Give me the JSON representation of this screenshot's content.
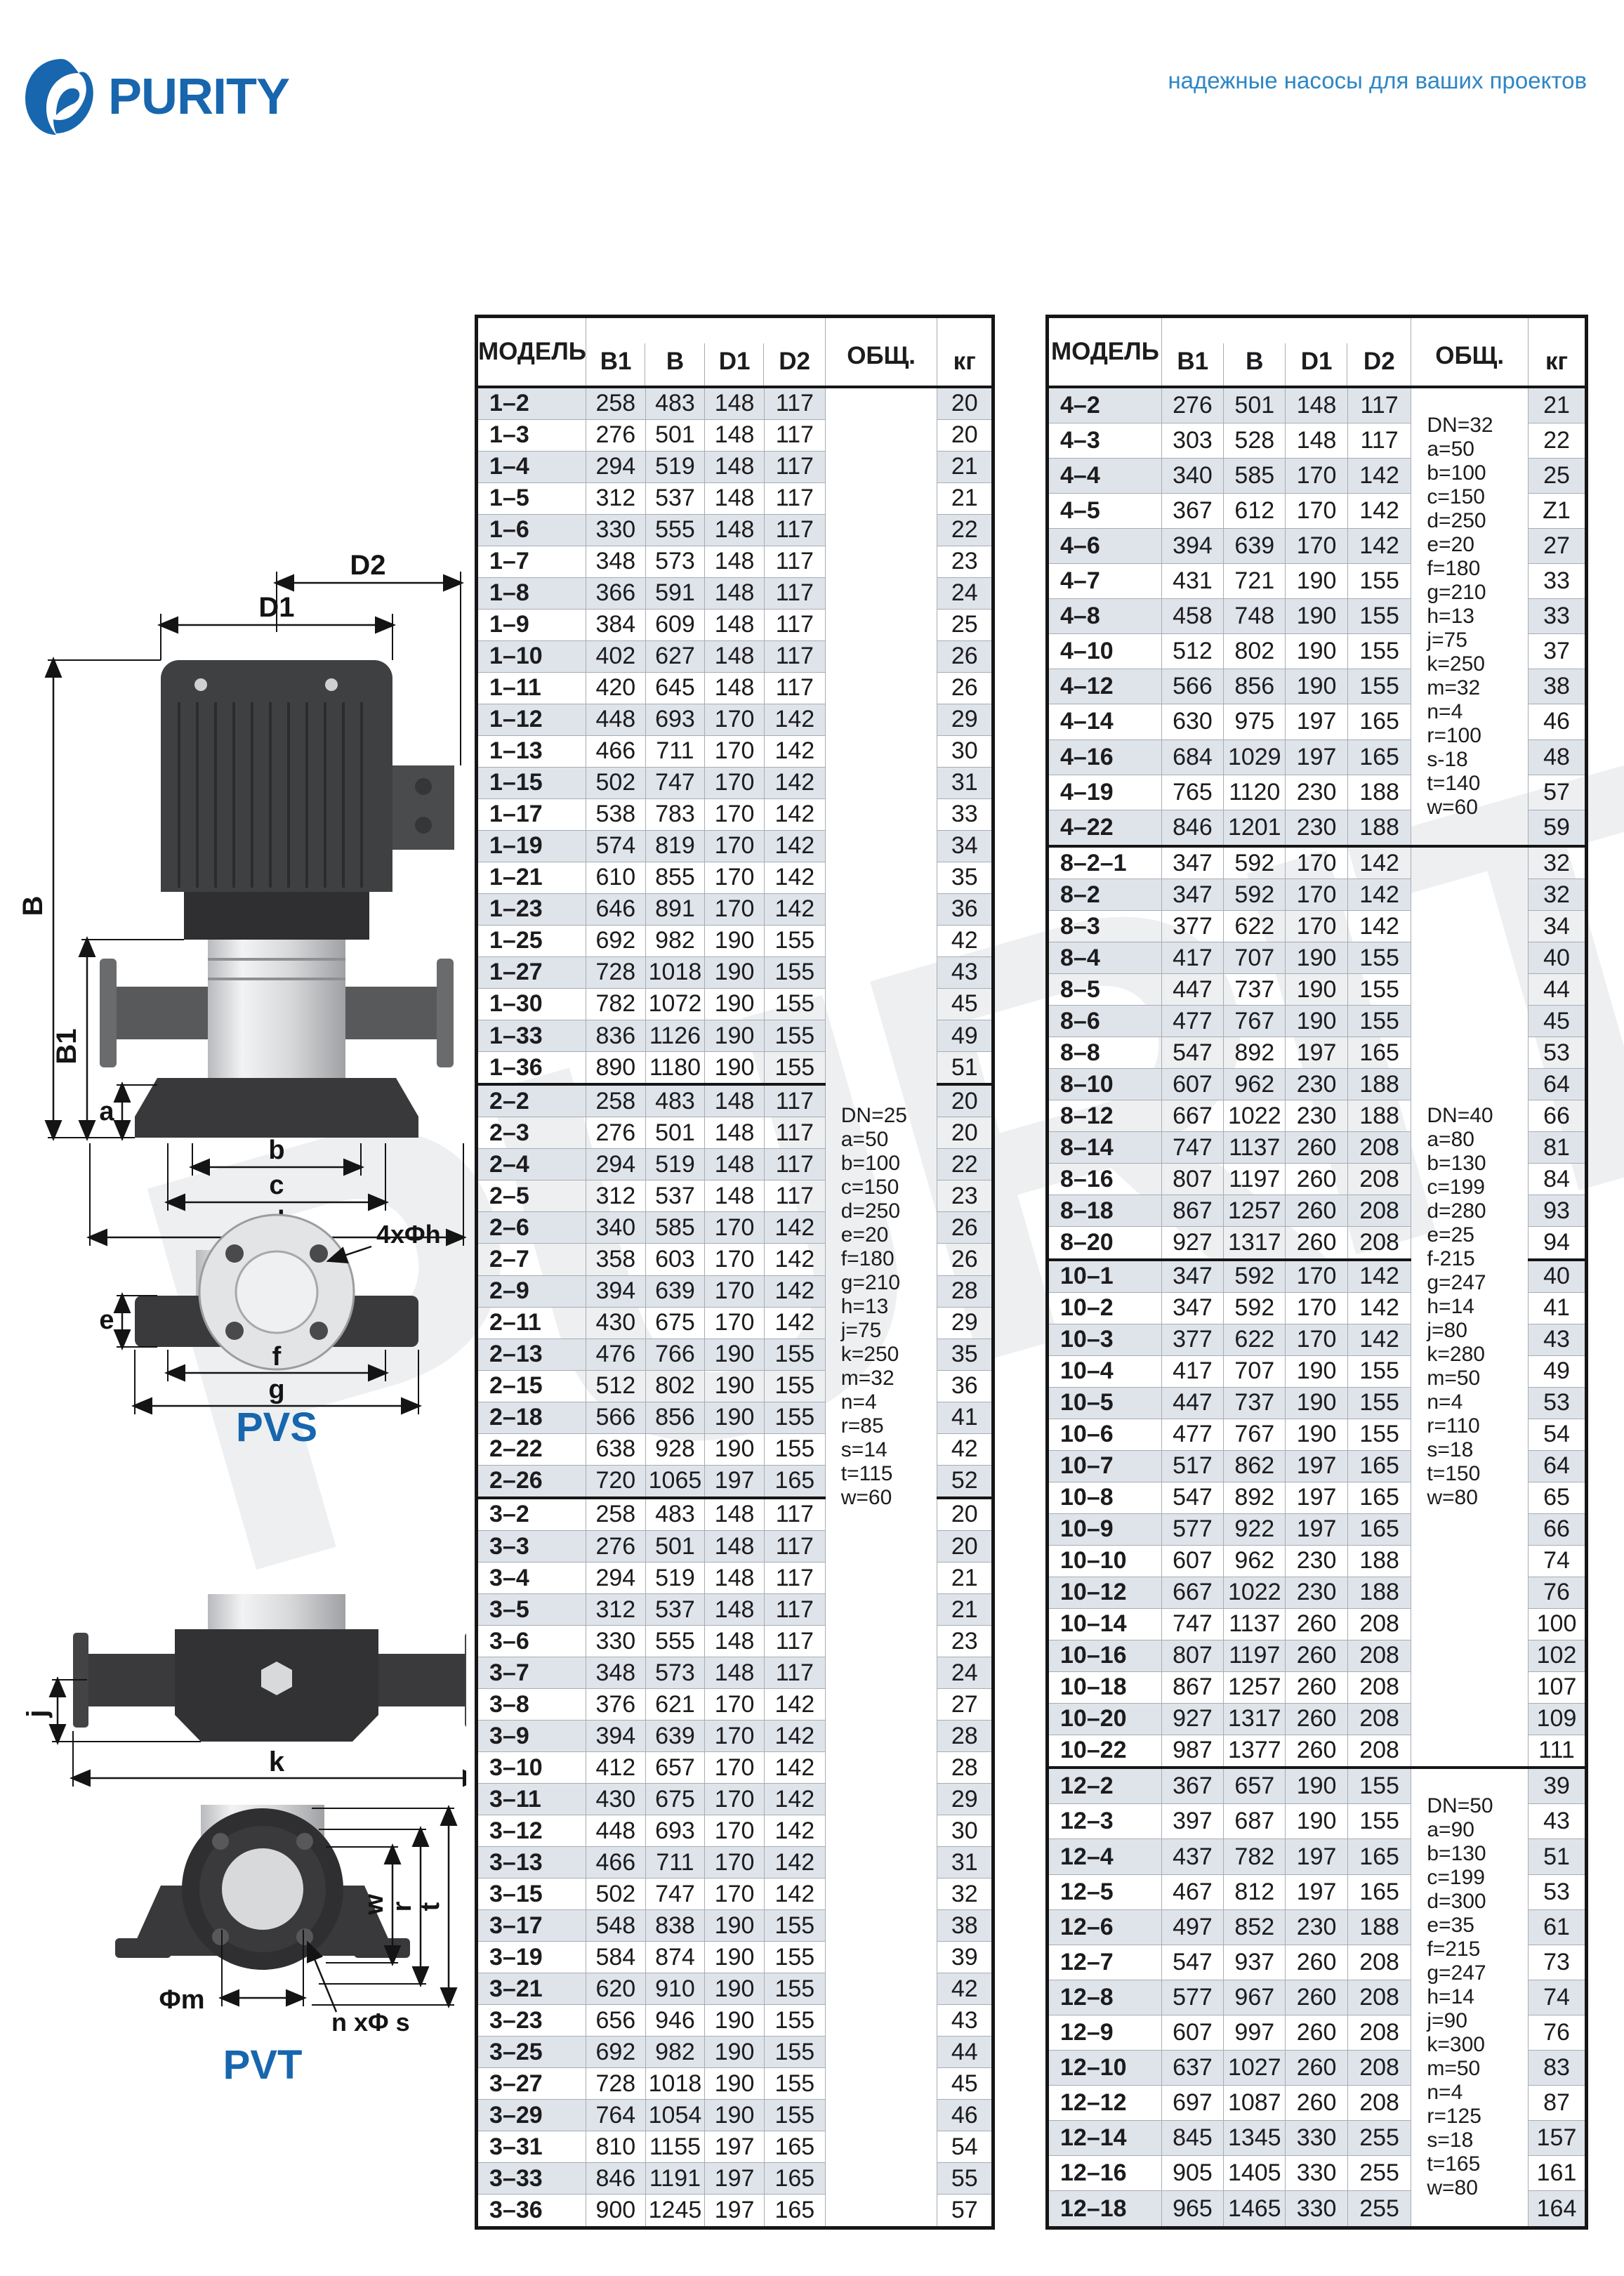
{
  "brand": {
    "logo_text": "PURITY",
    "tagline": "надежные насосы для ваших проектов"
  },
  "colors": {
    "brand_blue": "#1766ae",
    "tagline_blue": "#2e86c5",
    "row_shade": "#dfe4ea",
    "border_dark": "#161616",
    "border_light": "#a7adb3",
    "watermark": "#edeff1"
  },
  "diagrams": {
    "pvs": {
      "label": "PVS",
      "dims": {
        "D2": "D2",
        "D1": "D1",
        "B": "B",
        "B1": "B1",
        "a": "a",
        "b": "b",
        "c": "c",
        "d": "d",
        "bolt": "4xΦh",
        "e": "e",
        "f": "f",
        "g": "g"
      }
    },
    "pvt": {
      "label": "PVT",
      "dims": {
        "j": "j",
        "k": "k",
        "w": "w",
        "r": "r",
        "t": "t",
        "m": "Φm",
        "bolt": "n xΦ s"
      }
    }
  },
  "tables": [
    {
      "headers": {
        "model": "МОДЕЛЬ",
        "b1": "В1",
        "b": "В",
        "d1": "D1",
        "d2": "D2",
        "obsh": "ОБЩ.",
        "kg": "кг"
      },
      "col_widths": [
        "21.2%",
        "11.5%",
        "11.5%",
        "11.5%",
        "11.8%",
        "21.7%",
        "10.8%"
      ],
      "notes": [
        {
          "from_group": 0,
          "rowspan": 58,
          "lines": [
            "DN=25",
            "a=50",
            "b=100",
            "c=150",
            "d=250",
            "e=20",
            "f=180",
            "g=210",
            "h=13",
            "j=75",
            "k=250",
            "m=32",
            "n=4",
            "r=85",
            "s=14",
            "t=115",
            "w=60"
          ]
        }
      ],
      "groups": [
        [
          [
            "1–2",
            "258",
            "483",
            "148",
            "117",
            "20"
          ],
          [
            "1–3",
            "276",
            "501",
            "148",
            "117",
            "20"
          ],
          [
            "1–4",
            "294",
            "519",
            "148",
            "117",
            "21"
          ],
          [
            "1–5",
            "312",
            "537",
            "148",
            "117",
            "21"
          ],
          [
            "1–6",
            "330",
            "555",
            "148",
            "117",
            "22"
          ],
          [
            "1–7",
            "348",
            "573",
            "148",
            "117",
            "23"
          ],
          [
            "1–8",
            "366",
            "591",
            "148",
            "117",
            "24"
          ],
          [
            "1–9",
            "384",
            "609",
            "148",
            "117",
            "25"
          ],
          [
            "1–10",
            "402",
            "627",
            "148",
            "117",
            "26"
          ],
          [
            "1–11",
            "420",
            "645",
            "148",
            "117",
            "26"
          ],
          [
            "1–12",
            "448",
            "693",
            "170",
            "142",
            "29"
          ],
          [
            "1–13",
            "466",
            "711",
            "170",
            "142",
            "30"
          ],
          [
            "1–15",
            "502",
            "747",
            "170",
            "142",
            "31"
          ],
          [
            "1–17",
            "538",
            "783",
            "170",
            "142",
            "33"
          ],
          [
            "1–19",
            "574",
            "819",
            "170",
            "142",
            "34"
          ],
          [
            "1–21",
            "610",
            "855",
            "170",
            "142",
            "35"
          ],
          [
            "1–23",
            "646",
            "891",
            "170",
            "142",
            "36"
          ],
          [
            "1–25",
            "692",
            "982",
            "190",
            "155",
            "42"
          ],
          [
            "1–27",
            "728",
            "1018",
            "190",
            "155",
            "43"
          ],
          [
            "1–30",
            "782",
            "1072",
            "190",
            "155",
            "45"
          ],
          [
            "1–33",
            "836",
            "1126",
            "190",
            "155",
            "49"
          ],
          [
            "1–36",
            "890",
            "1180",
            "190",
            "155",
            "51"
          ]
        ],
        [
          [
            "2–2",
            "258",
            "483",
            "148",
            "117",
            "20"
          ],
          [
            "2–3",
            "276",
            "501",
            "148",
            "117",
            "20"
          ],
          [
            "2–4",
            "294",
            "519",
            "148",
            "117",
            "22"
          ],
          [
            "2–5",
            "312",
            "537",
            "148",
            "117",
            "23"
          ],
          [
            "2–6",
            "340",
            "585",
            "170",
            "142",
            "26"
          ],
          [
            "2–7",
            "358",
            "603",
            "170",
            "142",
            "26"
          ],
          [
            "2–9",
            "394",
            "639",
            "170",
            "142",
            "28"
          ],
          [
            "2–11",
            "430",
            "675",
            "170",
            "142",
            "29"
          ],
          [
            "2–13",
            "476",
            "766",
            "190",
            "155",
            "35"
          ],
          [
            "2–15",
            "512",
            "802",
            "190",
            "155",
            "36"
          ],
          [
            "2–18",
            "566",
            "856",
            "190",
            "155",
            "41"
          ],
          [
            "2–22",
            "638",
            "928",
            "190",
            "155",
            "42"
          ],
          [
            "2–26",
            "720",
            "1065",
            "197",
            "165",
            "52"
          ]
        ],
        [
          [
            "3–2",
            "258",
            "483",
            "148",
            "117",
            "20"
          ],
          [
            "3–3",
            "276",
            "501",
            "148",
            "117",
            "20"
          ],
          [
            "3–4",
            "294",
            "519",
            "148",
            "117",
            "21"
          ],
          [
            "3–5",
            "312",
            "537",
            "148",
            "117",
            "21"
          ],
          [
            "3–6",
            "330",
            "555",
            "148",
            "117",
            "23"
          ],
          [
            "3–7",
            "348",
            "573",
            "148",
            "117",
            "24"
          ],
          [
            "3–8",
            "376",
            "621",
            "170",
            "142",
            "27"
          ],
          [
            "3–9",
            "394",
            "639",
            "170",
            "142",
            "28"
          ],
          [
            "3–10",
            "412",
            "657",
            "170",
            "142",
            "28"
          ],
          [
            "3–11",
            "430",
            "675",
            "170",
            "142",
            "29"
          ],
          [
            "3–12",
            "448",
            "693",
            "170",
            "142",
            "30"
          ],
          [
            "3–13",
            "466",
            "711",
            "170",
            "142",
            "31"
          ],
          [
            "3–15",
            "502",
            "747",
            "170",
            "142",
            "32"
          ],
          [
            "3–17",
            "548",
            "838",
            "190",
            "155",
            "38"
          ],
          [
            "3–19",
            "584",
            "874",
            "190",
            "155",
            "39"
          ],
          [
            "3–21",
            "620",
            "910",
            "190",
            "155",
            "42"
          ],
          [
            "3–23",
            "656",
            "946",
            "190",
            "155",
            "43"
          ],
          [
            "3–25",
            "692",
            "982",
            "190",
            "155",
            "44"
          ],
          [
            "3–27",
            "728",
            "1018",
            "190",
            "155",
            "45"
          ],
          [
            "3–29",
            "764",
            "1054",
            "190",
            "155",
            "46"
          ],
          [
            "3–31",
            "810",
            "1155",
            "197",
            "165",
            "54"
          ],
          [
            "3–33",
            "846",
            "1191",
            "197",
            "165",
            "55"
          ],
          [
            "3–36",
            "900",
            "1245",
            "197",
            "165",
            "57"
          ]
        ]
      ]
    },
    {
      "headers": {
        "model": "МОДЕЛЬ",
        "b1": "В1",
        "b": "В",
        "d1": "D1",
        "d2": "D2",
        "obsh": "ОБЩ.",
        "kg": "кг"
      },
      "col_widths": [
        "21.2%",
        "11.5%",
        "11.5%",
        "11.5%",
        "11.8%",
        "21.7%",
        "10.8%"
      ],
      "notes": [
        {
          "from_group": 0,
          "rowspan": 13,
          "lines": [
            "DN=32",
            "a=50",
            "b=100",
            "c=150",
            "d=250",
            "e=20",
            "f=180",
            "g=210",
            "h=13",
            "j=75",
            "k=250",
            "m=32",
            "n=4",
            "r=100",
            "s-18",
            "t=140",
            "w=60"
          ]
        },
        {
          "from_group": 1,
          "rowspan": 29,
          "lines": [
            "DN=40",
            "a=80",
            "b=130",
            "c=199",
            "d=280",
            "e=25",
            "f-215",
            "g=247",
            "h=14",
            "j=80",
            "k=280",
            "m=50",
            "n=4",
            "r=110",
            "s=18",
            "t=150",
            "w=80"
          ]
        },
        {
          "from_group": 3,
          "rowspan": 13,
          "lines": [
            "DN=50",
            "a=90",
            "b=130",
            "c=199",
            "d=300",
            "e=35",
            "f=215",
            "g=247",
            "h=14",
            "j=90",
            "k=300",
            "m=50",
            "n=4",
            "r=125",
            "s=18",
            "t=165",
            "w=80"
          ]
        }
      ],
      "groups": [
        [
          [
            "4–2",
            "276",
            "501",
            "148",
            "117",
            "21"
          ],
          [
            "4–3",
            "303",
            "528",
            "148",
            "117",
            "22"
          ],
          [
            "4–4",
            "340",
            "585",
            "170",
            "142",
            "25"
          ],
          [
            "4–5",
            "367",
            "612",
            "170",
            "142",
            "Z1"
          ],
          [
            "4–6",
            "394",
            "639",
            "170",
            "142",
            "27"
          ],
          [
            "4–7",
            "431",
            "721",
            "190",
            "155",
            "33"
          ],
          [
            "4–8",
            "458",
            "748",
            "190",
            "155",
            "33"
          ],
          [
            "4–10",
            "512",
            "802",
            "190",
            "155",
            "37"
          ],
          [
            "4–12",
            "566",
            "856",
            "190",
            "155",
            "38"
          ],
          [
            "4–14",
            "630",
            "975",
            "197",
            "165",
            "46"
          ],
          [
            "4–16",
            "684",
            "1029",
            "197",
            "165",
            "48"
          ],
          [
            "4–19",
            "765",
            "1120",
            "230",
            "188",
            "57"
          ],
          [
            "4–22",
            "846",
            "1201",
            "230",
            "188",
            "59"
          ]
        ],
        [
          [
            "8–2–1",
            "347",
            "592",
            "170",
            "142",
            "32"
          ],
          [
            "8–2",
            "347",
            "592",
            "170",
            "142",
            "32"
          ],
          [
            "8–3",
            "377",
            "622",
            "170",
            "142",
            "34"
          ],
          [
            "8–4",
            "417",
            "707",
            "190",
            "155",
            "40"
          ],
          [
            "8–5",
            "447",
            "737",
            "190",
            "155",
            "44"
          ],
          [
            "8–6",
            "477",
            "767",
            "190",
            "155",
            "45"
          ],
          [
            "8–8",
            "547",
            "892",
            "197",
            "165",
            "53"
          ],
          [
            "8–10",
            "607",
            "962",
            "230",
            "188",
            "64"
          ],
          [
            "8–12",
            "667",
            "1022",
            "230",
            "188",
            "66"
          ],
          [
            "8–14",
            "747",
            "1137",
            "260",
            "208",
            "81"
          ],
          [
            "8–16",
            "807",
            "1197",
            "260",
            "208",
            "84"
          ],
          [
            "8–18",
            "867",
            "1257",
            "260",
            "208",
            "93"
          ],
          [
            "8–20",
            "927",
            "1317",
            "260",
            "208",
            "94"
          ]
        ],
        [
          [
            "10–1",
            "347",
            "592",
            "170",
            "142",
            "40"
          ],
          [
            "10–2",
            "347",
            "592",
            "170",
            "142",
            "41"
          ],
          [
            "10–3",
            "377",
            "622",
            "170",
            "142",
            "43"
          ],
          [
            "10–4",
            "417",
            "707",
            "190",
            "155",
            "49"
          ],
          [
            "10–5",
            "447",
            "737",
            "190",
            "155",
            "53"
          ],
          [
            "10–6",
            "477",
            "767",
            "190",
            "155",
            "54"
          ],
          [
            "10–7",
            "517",
            "862",
            "197",
            "165",
            "64"
          ],
          [
            "10–8",
            "547",
            "892",
            "197",
            "165",
            "65"
          ],
          [
            "10–9",
            "577",
            "922",
            "197",
            "165",
            "66"
          ],
          [
            "10–10",
            "607",
            "962",
            "230",
            "188",
            "74"
          ],
          [
            "10–12",
            "667",
            "1022",
            "230",
            "188",
            "76"
          ],
          [
            "10–14",
            "747",
            "1137",
            "260",
            "208",
            "100"
          ],
          [
            "10–16",
            "807",
            "1197",
            "260",
            "208",
            "102"
          ],
          [
            "10–18",
            "867",
            "1257",
            "260",
            "208",
            "107"
          ],
          [
            "10–20",
            "927",
            "1317",
            "260",
            "208",
            "109"
          ],
          [
            "10–22",
            "987",
            "1377",
            "260",
            "208",
            "111"
          ]
        ],
        [
          [
            "12–2",
            "367",
            "657",
            "190",
            "155",
            "39"
          ],
          [
            "12–3",
            "397",
            "687",
            "190",
            "155",
            "43"
          ],
          [
            "12–4",
            "437",
            "782",
            "197",
            "165",
            "51"
          ],
          [
            "12–5",
            "467",
            "812",
            "197",
            "165",
            "53"
          ],
          [
            "12–6",
            "497",
            "852",
            "230",
            "188",
            "61"
          ],
          [
            "12–7",
            "547",
            "937",
            "260",
            "208",
            "73"
          ],
          [
            "12–8",
            "577",
            "967",
            "260",
            "208",
            "74"
          ],
          [
            "12–9",
            "607",
            "997",
            "260",
            "208",
            "76"
          ],
          [
            "12–10",
            "637",
            "1027",
            "260",
            "208",
            "83"
          ],
          [
            "12–12",
            "697",
            "1087",
            "260",
            "208",
            "87"
          ],
          [
            "12–14",
            "845",
            "1345",
            "330",
            "255",
            "157"
          ],
          [
            "12–16",
            "905",
            "1405",
            "330",
            "255",
            "161"
          ],
          [
            "12–18",
            "965",
            "1465",
            "330",
            "255",
            "164"
          ]
        ]
      ]
    }
  ]
}
